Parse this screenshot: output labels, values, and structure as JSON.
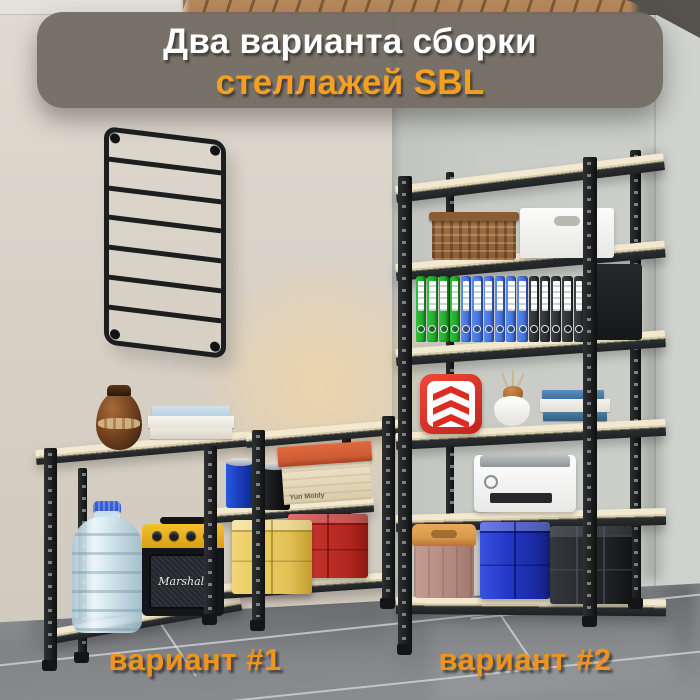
{
  "banner": {
    "title_line1": "Два варианта сборки",
    "title_line2": "стеллажей SBL"
  },
  "variant_labels": {
    "variant1": "вариант #1",
    "variant2": "вариант #2"
  },
  "decor_text": {
    "speaker_logo": "Marshall",
    "cardboard_box_text": "Yun Moldy"
  },
  "colors": {
    "accent_orange": "#f6a021",
    "label_orange": "#ef941c",
    "banner_bg": "#746e66",
    "wall_left": "#d9d2c7",
    "wall_back": "#c7cac4",
    "floor_gray": "#85878a",
    "metal_dark": "#212426",
    "board_wood": "#ecdfc0",
    "binder_green": "#2fc23a",
    "binder_blue": "#5b8af0",
    "binder_dark": "#3d4145",
    "crate_yellow": "#eac95f",
    "crate_red": "#c13029",
    "crate_blue": "#2338c6",
    "crate_black": "#26292c",
    "cap_blue": "#2f55c8",
    "cooler_tan": "#d89a4e",
    "lid_orange": "#cd5b35"
  },
  "scene": {
    "wall_rack": "black ladder wall rack",
    "variant1": {
      "label": "вариант #1",
      "items": [
        "brown ceramic vase",
        "stack of books",
        "19L water bottle",
        "Marshall speaker",
        "blue paint can",
        "black paint can",
        "cardboard box with orange lid",
        "yellow plastic crate",
        "red plastic crate"
      ]
    },
    "variant2": {
      "label": "вариант #2",
      "items": [
        "wicker basket",
        "white storage box",
        "ring binders",
        "black box",
        "red logo box",
        "white vase with sprigs",
        "stack of books",
        "white printer",
        "tan cooler box",
        "blue plastic crate",
        "black plastic crate"
      ],
      "binders": [
        {
          "name": "binder-green",
          "css": "bg-g",
          "count": 4
        },
        {
          "name": "binder-blue",
          "css": "bg-b",
          "count": 6
        },
        {
          "name": "binder-dark",
          "css": "bg-k",
          "count": 5
        }
      ]
    }
  }
}
